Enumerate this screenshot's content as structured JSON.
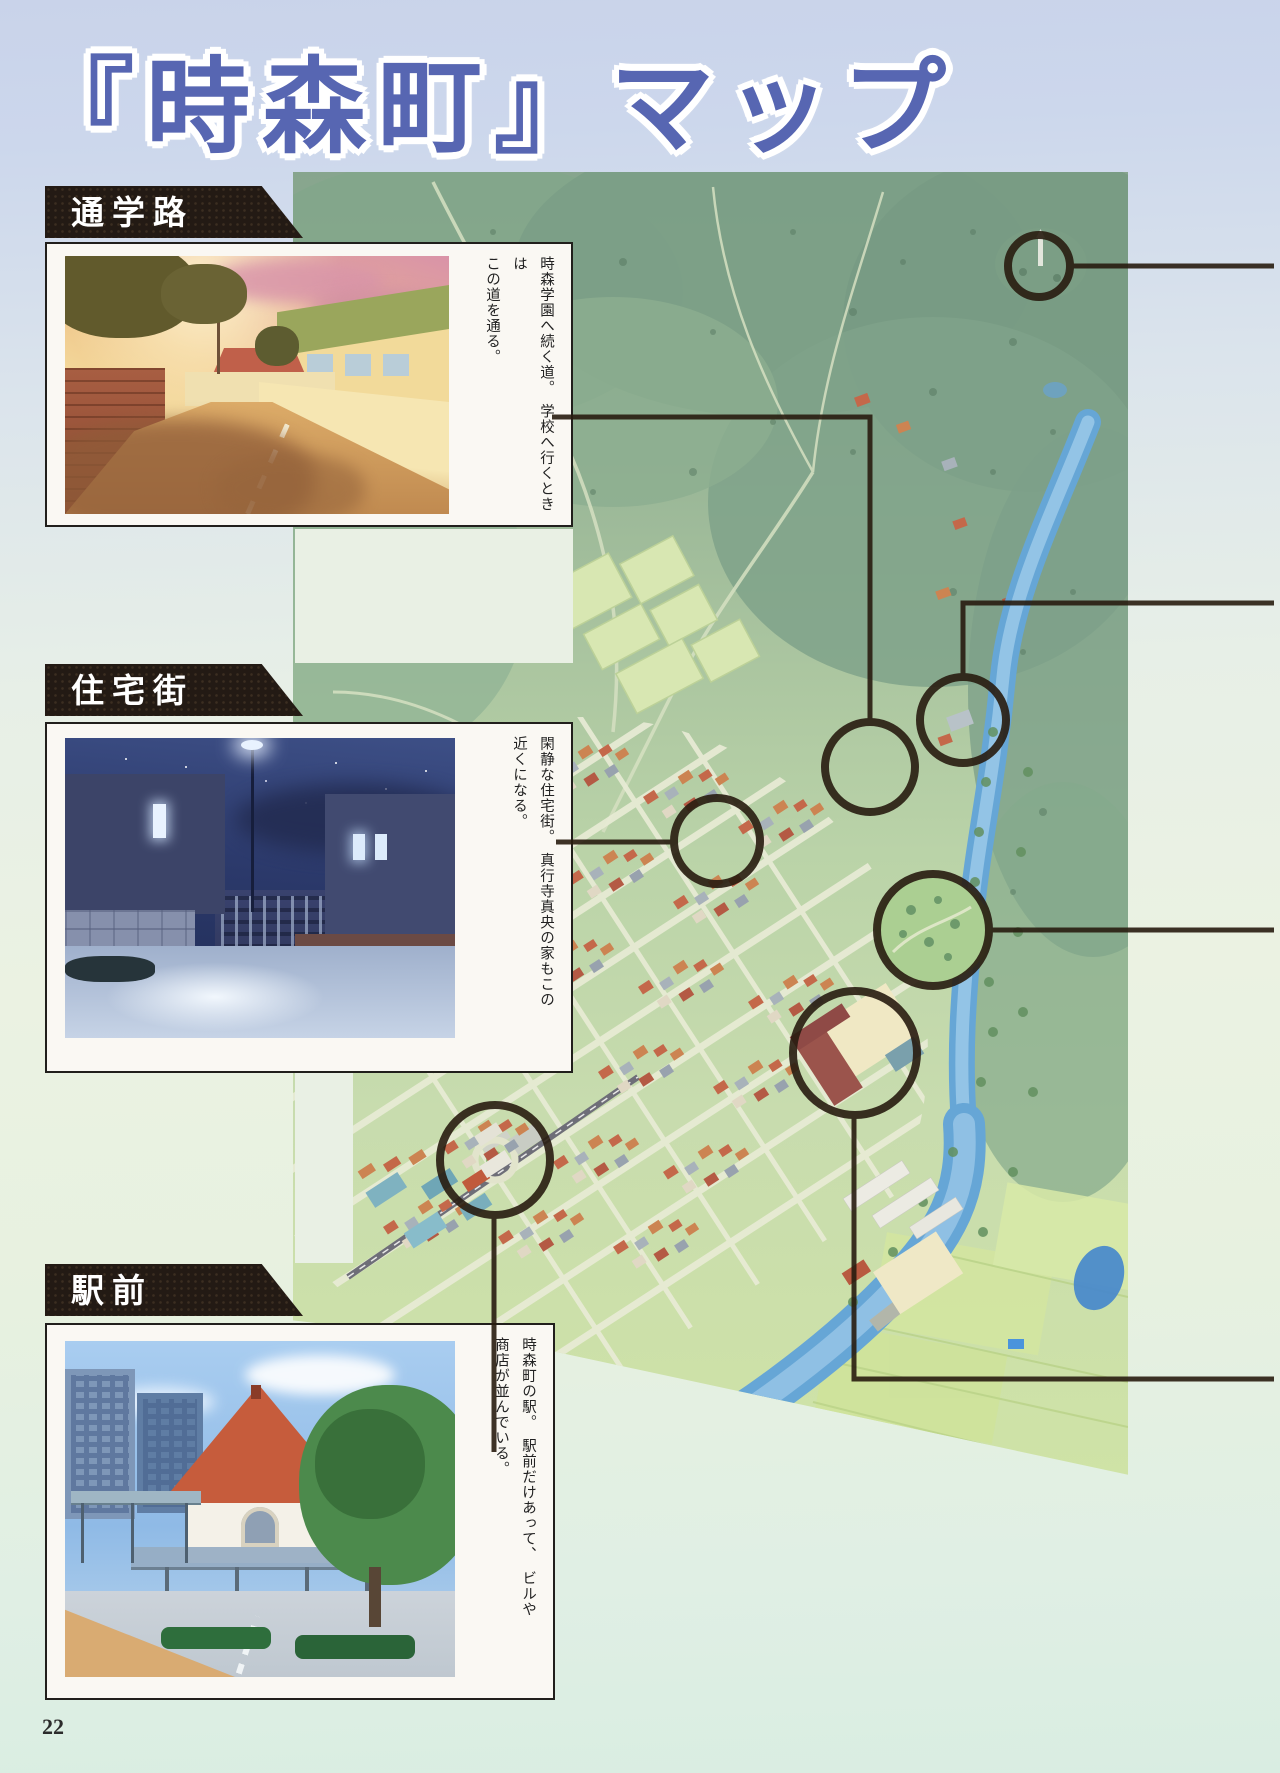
{
  "page": {
    "title": "『時森町』マップ",
    "page_number": "22"
  },
  "map": {
    "town_name": "時森町",
    "marker_count": 7
  },
  "sections": [
    {
      "id": "school-road",
      "label": "通学路",
      "caption": "時森学園へ続く道。　学校へ行くときは\nこの道を通る。",
      "photo": "sunset-street-scene"
    },
    {
      "id": "residential",
      "label": "住宅街",
      "caption": "閑静な住宅街。　真行寺真央の家もこの\n近くになる。",
      "photo": "night-street-scene"
    },
    {
      "id": "station-front",
      "label": "駅前",
      "caption": "時森町の駅。　駅前だけあって、　ビルや\n商店が並んでいる。",
      "photo": "station-building-scene"
    }
  ]
}
